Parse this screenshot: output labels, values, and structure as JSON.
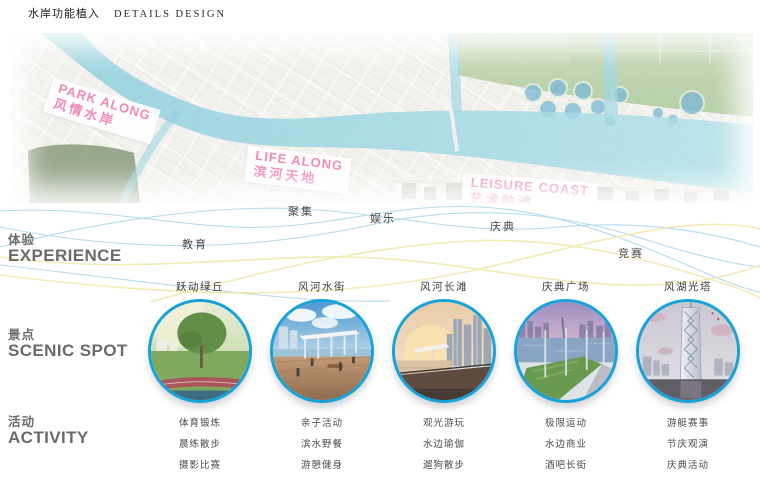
{
  "page": {
    "title_cn": "水岸功能植入",
    "title_en": "DETAILS DESIGN"
  },
  "map": {
    "labels": [
      {
        "en": "PARK ALONG",
        "cn": "风情水岸"
      },
      {
        "en": "LIFE ALONG",
        "cn": "滨河天地"
      },
      {
        "en": "LEISURE COAST",
        "cn": "艺术前滩"
      }
    ]
  },
  "sections": {
    "experience": {
      "cn": "体验",
      "en": "EXPERIENCE",
      "keywords": [
        "教育",
        "聚集",
        "娱乐",
        "庆典",
        "竞赛"
      ]
    },
    "scenic": {
      "cn": "景点",
      "en": "SCENIC SPOT"
    },
    "activity": {
      "cn": "活动",
      "en": "ACTIVITY"
    }
  },
  "spots": [
    {
      "name": "跃动绿丘",
      "activities": [
        "体育锻炼",
        "晨练散步",
        "摄影比赛"
      ]
    },
    {
      "name": "风河水街",
      "activities": [
        "亲子活动",
        "滨水野餐",
        "游憩健身"
      ]
    },
    {
      "name": "风河长滩",
      "activities": [
        "观光游玩",
        "水边瑜伽",
        "遛狗散步"
      ]
    },
    {
      "name": "庆典广场",
      "activities": [
        "极限运动",
        "水边商业",
        "酒吧长街"
      ]
    },
    {
      "name": "风湖光塔",
      "activities": [
        "游艇赛事",
        "节庆观演",
        "庆典活动"
      ]
    }
  ],
  "colors": {
    "accent_ring": "#17a2da",
    "label_pink": "#e7579f",
    "ribbon_blue": "#b3dbed",
    "ribbon_yellow": "#f1e9ad"
  }
}
